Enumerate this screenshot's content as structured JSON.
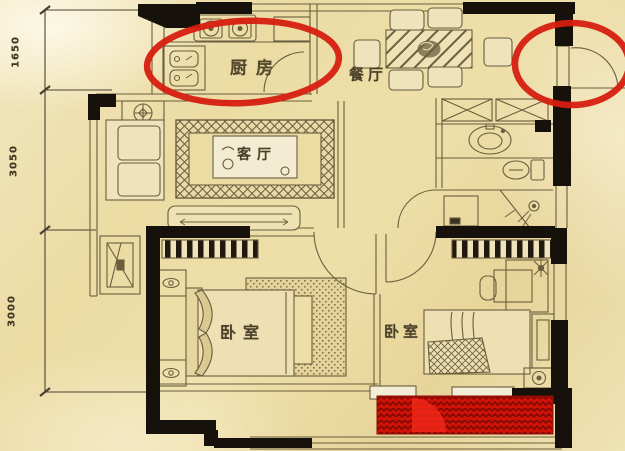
{
  "document": {
    "kind": "apartment floor plan, hand-drawn style on parchment paper",
    "highlight_note": "red ellipses circle the kitchen and the entry window; balcony floor highlighted red"
  },
  "rooms": {
    "kitchen": {
      "label": "厨房"
    },
    "dining_room": {
      "label": "餐厅"
    },
    "living_room": {
      "label": "客厅"
    },
    "bedroom_main": {
      "label": "卧室"
    },
    "bedroom_second": {
      "label": "卧室"
    }
  },
  "dimensions": {
    "left": [
      {
        "value": "1650"
      },
      {
        "value": "3050"
      },
      {
        "value": "3000"
      }
    ]
  },
  "annotations": {
    "kitchen_circle": {
      "shape": "ellipse",
      "color": "#d61e10"
    },
    "entry_window_circle": {
      "shape": "ellipse",
      "color": "#d61e10"
    },
    "balcony_highlight": {
      "shape": "hatched-rect",
      "color": "#cf1208"
    }
  },
  "colors": {
    "paper": "#eedfa9",
    "line": "#6a5e3e",
    "wall": "#16120b",
    "annotation_red": "#d61e10",
    "balcony_red": "#cf1208"
  }
}
